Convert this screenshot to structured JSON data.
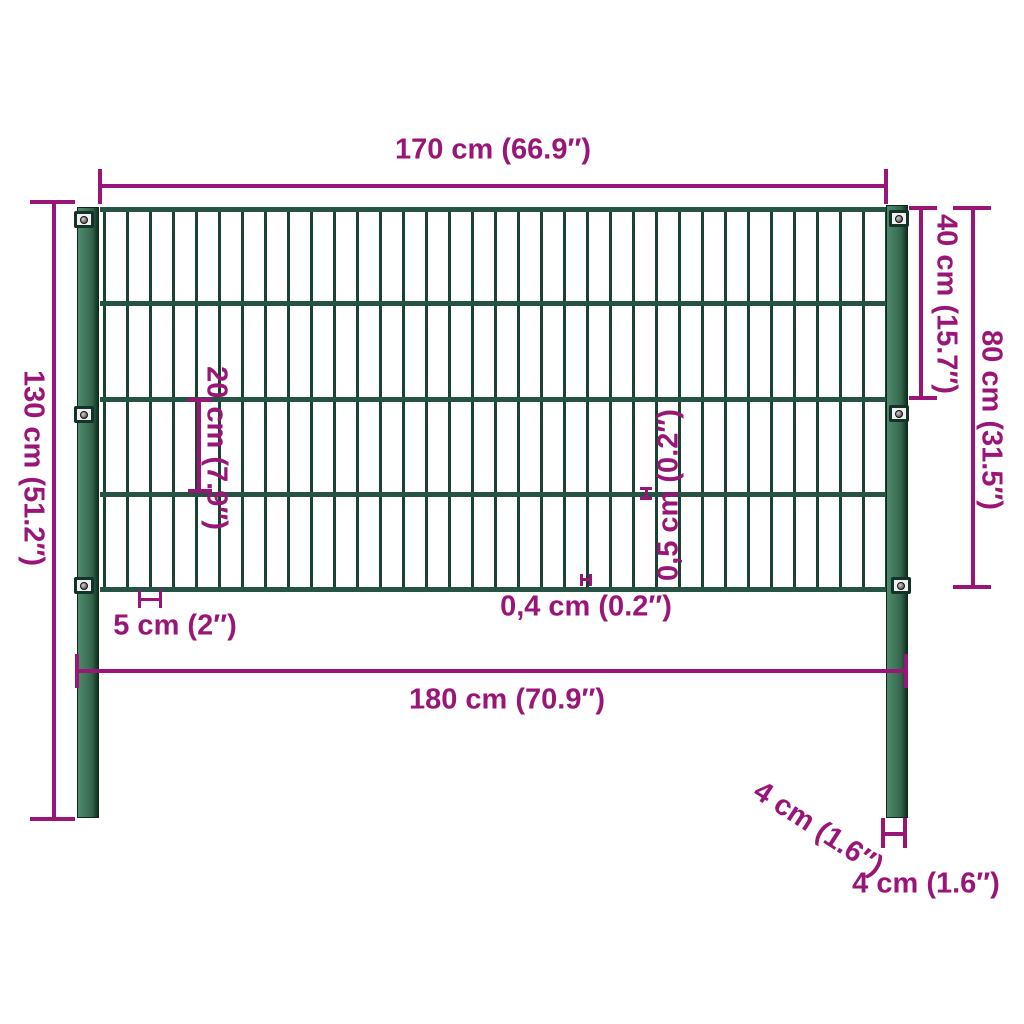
{
  "diagram": {
    "subject": "fence-panel-with-posts-dimension-diagram",
    "labels": {
      "panel_width": "170 cm (66.9″)",
      "post_height": "130 cm (51.2″)",
      "section_height": "40 cm (15.7″)",
      "panel_height": "80 cm (31.5″)",
      "rail_spacing": "20 cm (7.9″)",
      "wire_spacing": "5 cm (2″)",
      "vertical_wire_thickness": "0,4 cm (0.2″)",
      "horizontal_wire_thickness": "0,5 cm (0.2″)",
      "post_spacing": "180 cm (70.9″)",
      "post_depth": "4 cm (1.6″)",
      "post_width": "4 cm (1.6″)"
    },
    "colors": {
      "dimension_magenta": "#9A1578",
      "post_green": "#3E7458",
      "wire_green": "#1B4334",
      "rail_green": "#265346",
      "bracket_gray": "#F0F0F0",
      "background": "#FFFFFF"
    }
  }
}
